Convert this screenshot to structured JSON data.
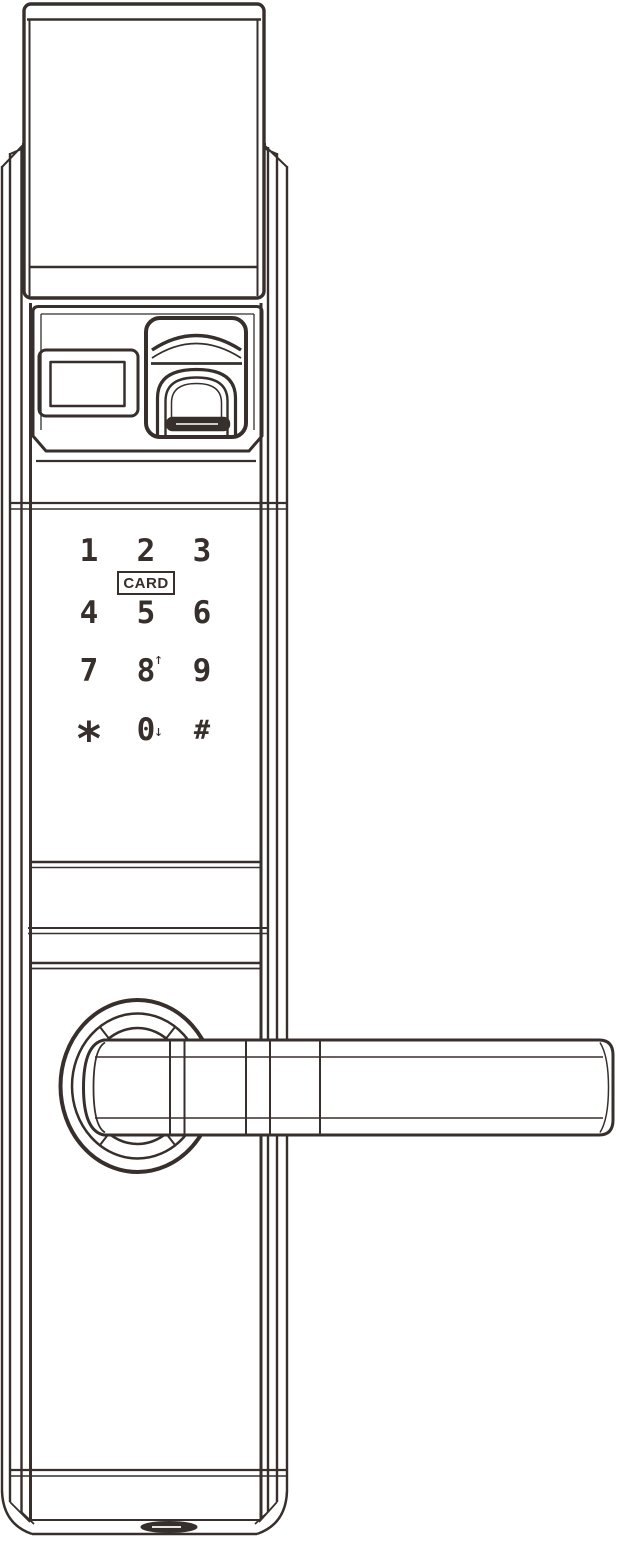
{
  "colors": {
    "line": "#362f2c",
    "background": "#ffffff"
  },
  "keypad": {
    "card_label": "CARD",
    "keys": [
      {
        "label": "1",
        "arrow": ""
      },
      {
        "label": "2",
        "arrow": ""
      },
      {
        "label": "3",
        "arrow": ""
      },
      {
        "label": "4",
        "arrow": ""
      },
      {
        "label": "5",
        "arrow": ""
      },
      {
        "label": "6",
        "arrow": ""
      },
      {
        "label": "7",
        "arrow": ""
      },
      {
        "label": "8",
        "arrow": "↑"
      },
      {
        "label": "9",
        "arrow": ""
      },
      {
        "label": "*",
        "arrow": ""
      },
      {
        "label": "0",
        "arrow": "↓"
      },
      {
        "label": "#",
        "arrow": ""
      }
    ]
  }
}
